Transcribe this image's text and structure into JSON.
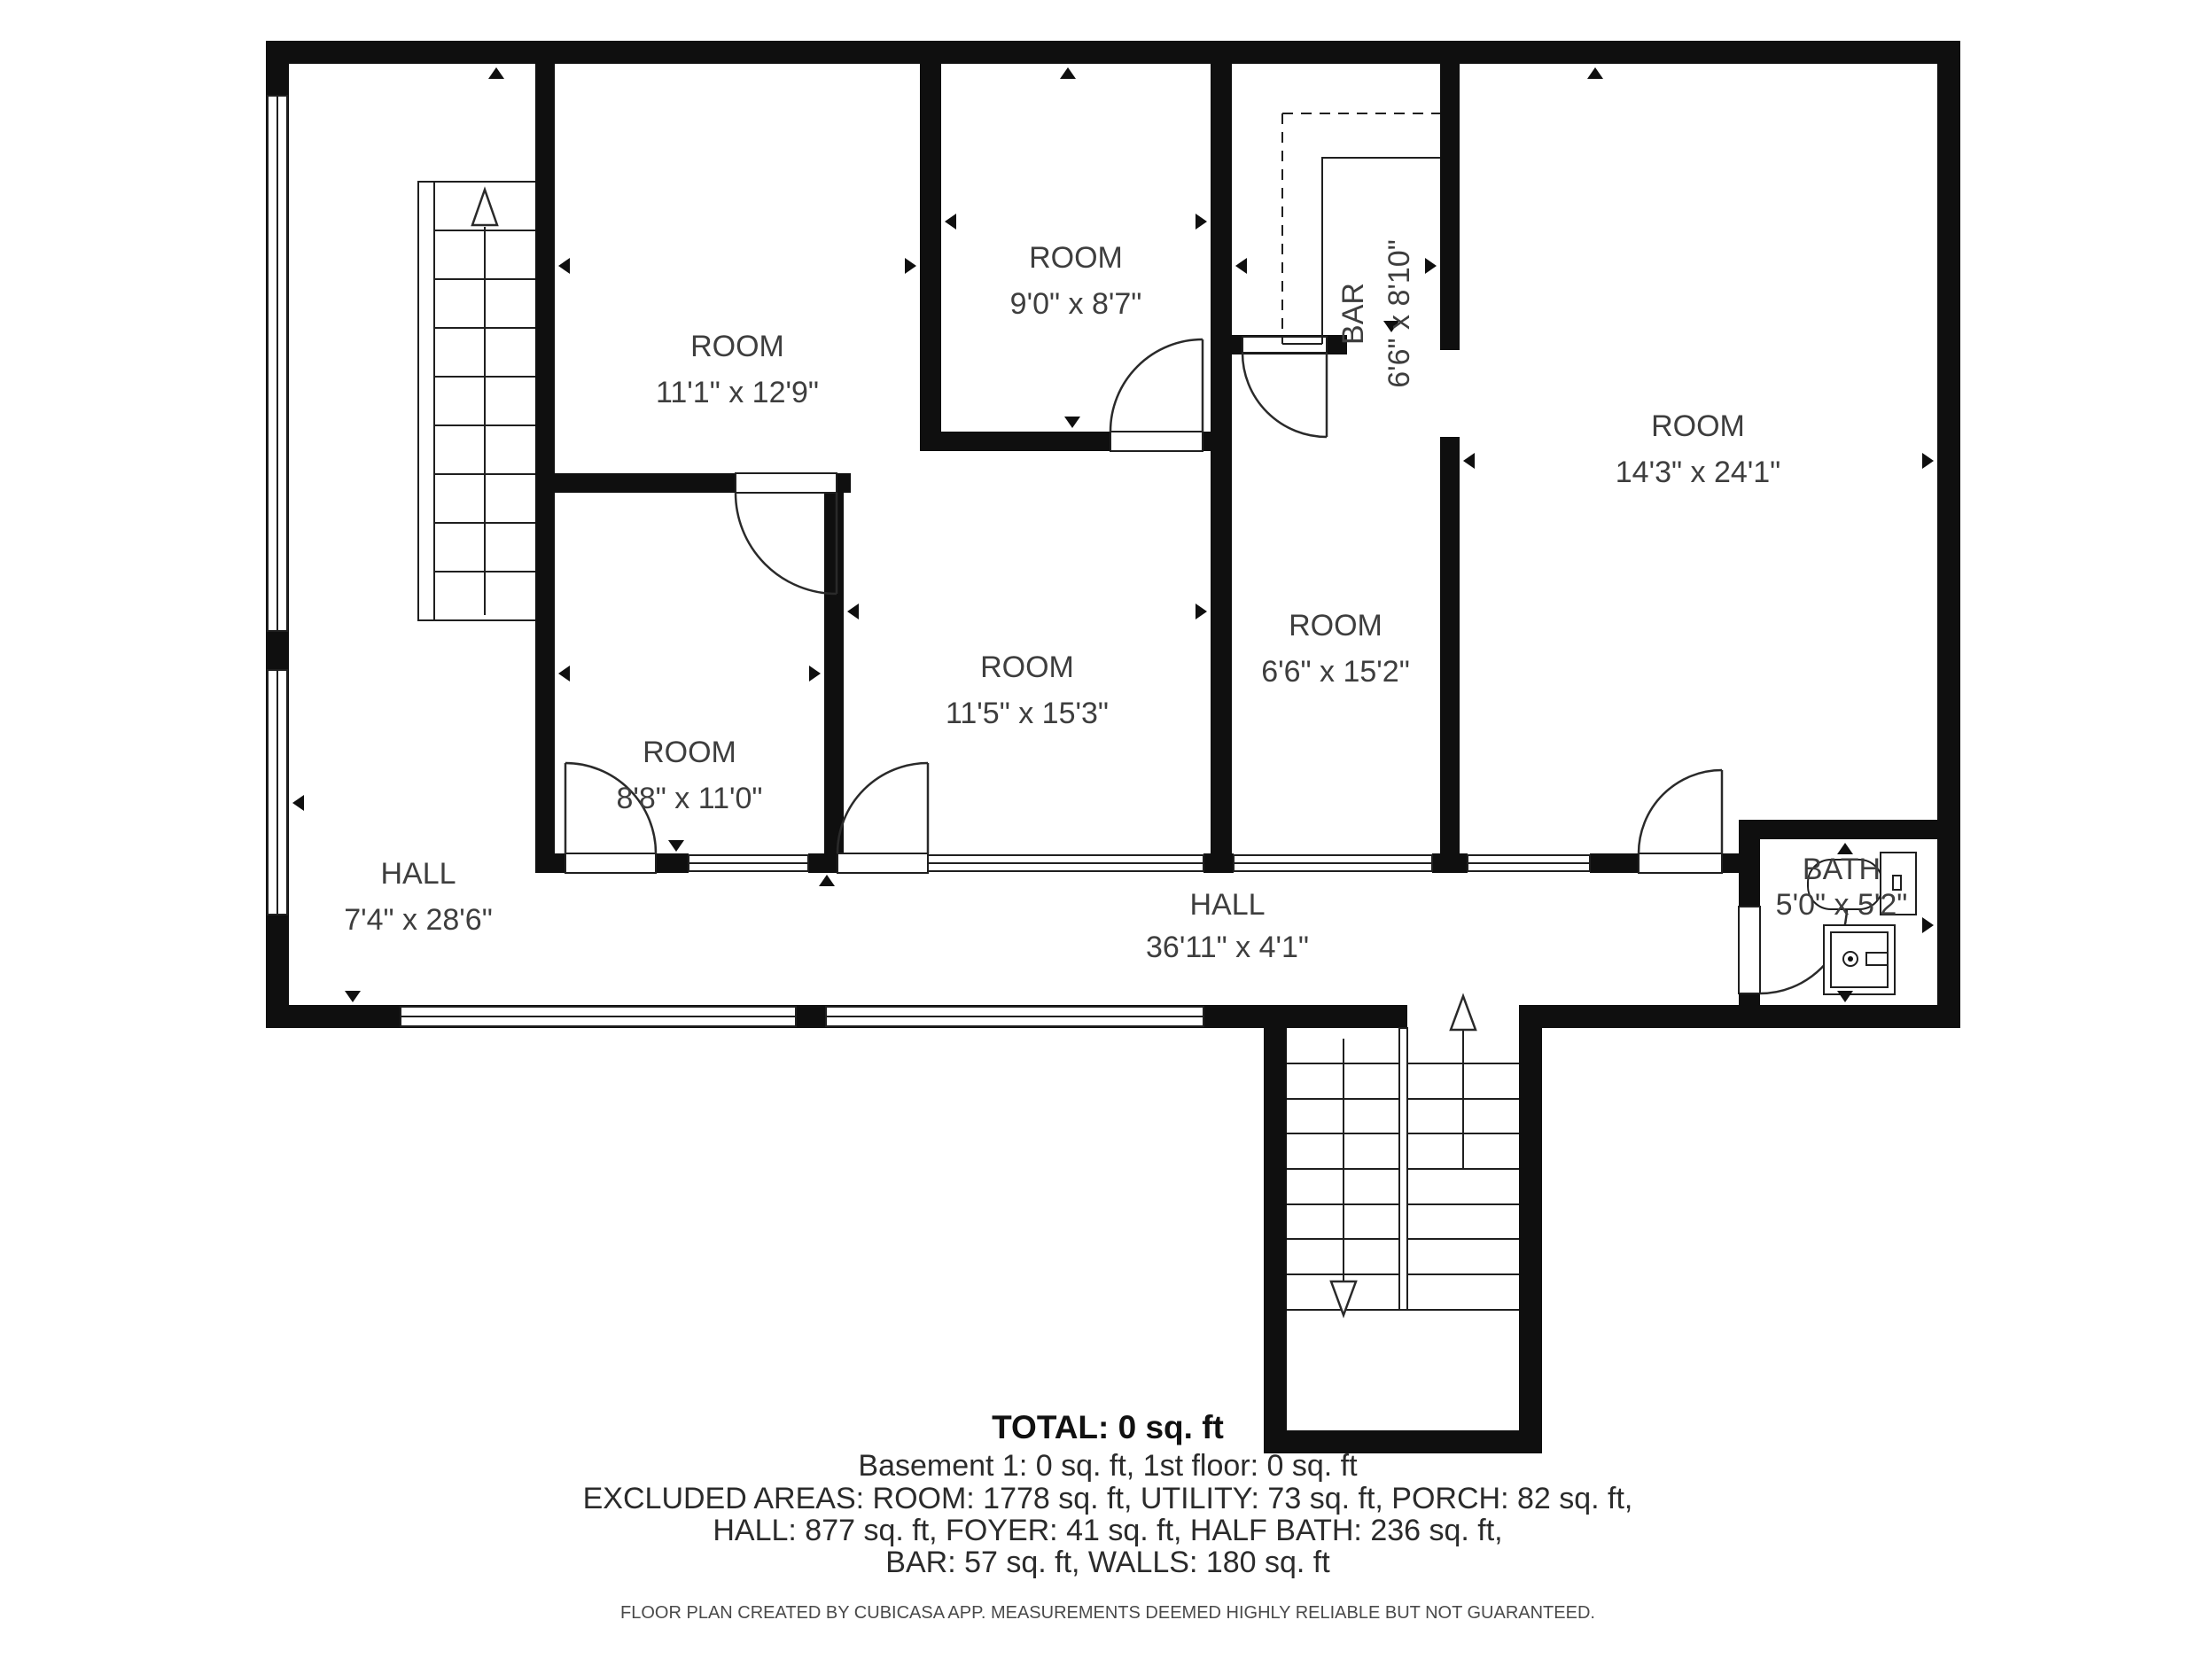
{
  "floorplan": {
    "rooms": [
      {
        "name": "ROOM",
        "dims": "11'1\" x 12'9\""
      },
      {
        "name": "ROOM",
        "dims": "9'0\" x 8'7\""
      },
      {
        "name": "BAR",
        "dims": "6'6\" x 8'10\""
      },
      {
        "name": "ROOM",
        "dims": "14'3\" x 24'1\""
      },
      {
        "name": "ROOM",
        "dims": "8'8\" x 11'0\""
      },
      {
        "name": "ROOM",
        "dims": "11'5\" x 15'3\""
      },
      {
        "name": "ROOM",
        "dims": "6'6\" x 15'2\""
      },
      {
        "name": "HALL",
        "dims": "7'4\" x 28'6\""
      },
      {
        "name": "HALL",
        "dims": "36'11\" x 4'1\""
      },
      {
        "name": "BATH",
        "dims": "5'0\" x 5'2\""
      }
    ],
    "summary": {
      "total": "TOTAL: 0 sq. ft",
      "line2": "Basement 1: 0 sq. ft, 1st floor: 0 sq. ft",
      "line3": "EXCLUDED AREAS: ROOM: 1778 sq. ft, UTILITY: 73 sq. ft, PORCH: 82 sq. ft,",
      "line4": "HALL: 877 sq. ft, FOYER: 41 sq. ft, HALF BATH: 236 sq. ft,",
      "line5": "BAR: 57 sq. ft, WALLS: 180 sq. ft"
    },
    "footer": "FLOOR PLAN CREATED BY CUBICASA APP. MEASUREMENTS DEEMED HIGHLY RELIABLE BUT NOT GUARANTEED."
  }
}
